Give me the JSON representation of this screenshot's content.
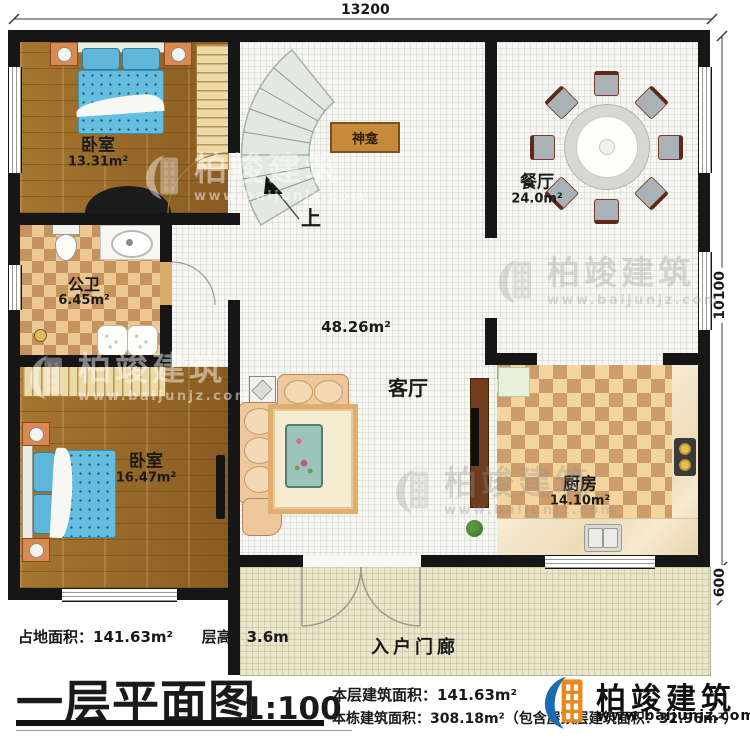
{
  "plan": {
    "dims": {
      "top": "13200",
      "right": "10100",
      "right_lower": "600"
    },
    "rooms": {
      "bedroom1": {
        "name": "卧室",
        "area": "13.31m²"
      },
      "bathroom": {
        "name": "公卫",
        "area": "6.45m²"
      },
      "bedroom2": {
        "name": "卧室",
        "area": "16.47m²"
      },
      "dining": {
        "name": "餐厅",
        "area": "24.0m²"
      },
      "living": {
        "name": "客厅",
        "area": "48.26m²"
      },
      "kitchen": {
        "name": "厨房",
        "area": "14.10m²"
      },
      "porch": {
        "name": "入户门廊"
      },
      "shrine": {
        "name": "神龛"
      },
      "stairs": {
        "direction": "上"
      }
    }
  },
  "footer": {
    "site_area": "占地面积：141.63m²",
    "floor_height": "层高：3.6m",
    "title": "一层平面图",
    "scale": "1:100",
    "floor_area": "本层建筑面积：141.63m²",
    "total_area": "本栋建筑面积：308.18m²（包含屋顶层建筑面积：32.96m²）"
  },
  "brand": {
    "name": "柏竣建筑",
    "website": "www.baijunjz.com"
  },
  "colors": {
    "wall": "#161616",
    "wood_floor": "#996a2c",
    "tile_floor": "#f6f6f3",
    "kitchen_checker": "#f3d69e",
    "bath_checker": "#ecc992",
    "porch_floor": "#e9e6cc",
    "bed_blue": "#66bede",
    "brand_blue": "#1c6ab0",
    "brand_orange": "#e8891d"
  }
}
